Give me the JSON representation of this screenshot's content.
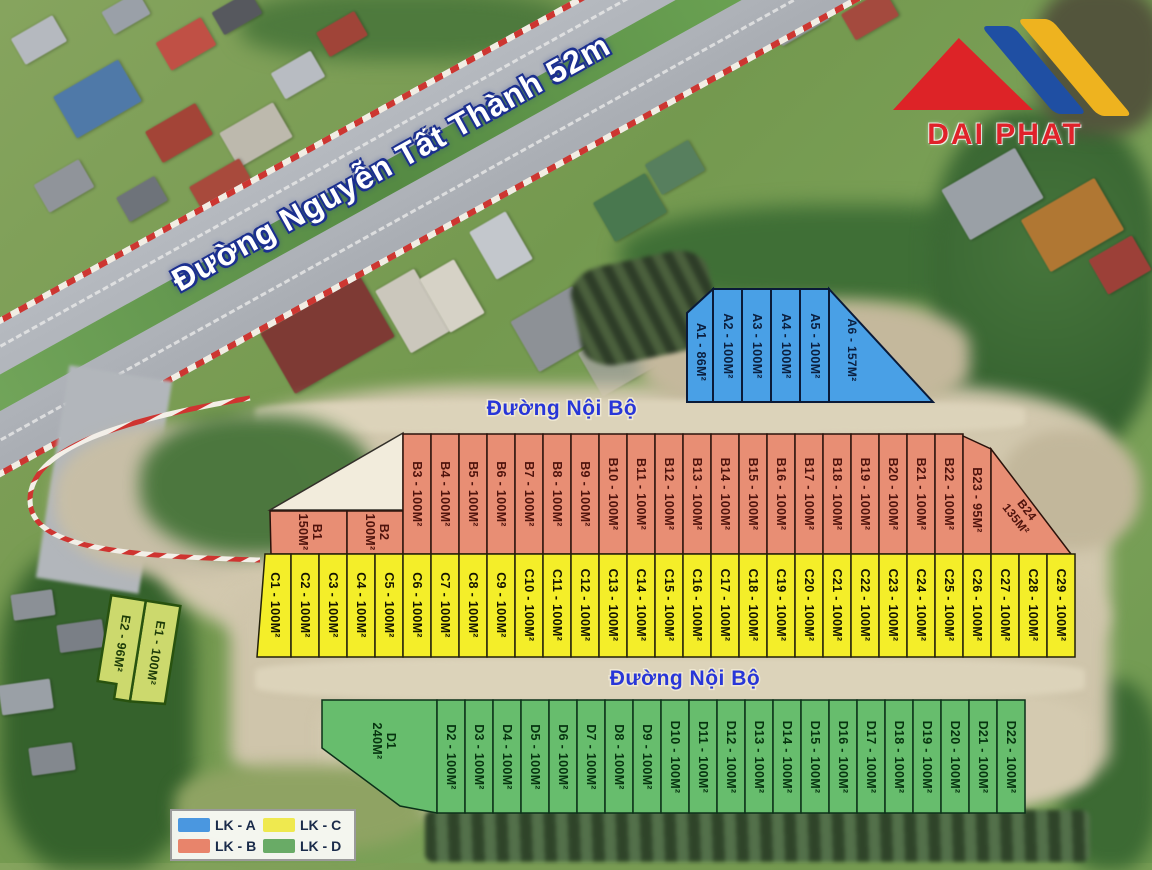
{
  "brand": {
    "logo_text": "DAI PHAT"
  },
  "roads": {
    "main_road_label": "Đường Nguyễn Tất Thành 52m",
    "internal_road_top_label": "Đường Nội Bộ",
    "internal_road_bottom_label": "Đường Nội Bộ"
  },
  "legend": {
    "items": [
      {
        "code": "LK - A",
        "color": "#4a97e0"
      },
      {
        "code": "LK - B",
        "color": "#e8846b"
      },
      {
        "code": "LK - C",
        "color": "#efe94f"
      },
      {
        "code": "LK - D",
        "color": "#69ab66"
      }
    ]
  },
  "blocks": {
    "A": {
      "name": "LK - A",
      "color": "#49a0e6",
      "plots": [
        {
          "id": "A1",
          "area": "86M²"
        },
        {
          "id": "A2",
          "area": "100M²"
        },
        {
          "id": "A3",
          "area": "100M²"
        },
        {
          "id": "A4",
          "area": "100M²"
        },
        {
          "id": "A5",
          "area": "100M²"
        },
        {
          "id": "A6",
          "area": "157M²"
        }
      ]
    },
    "B": {
      "name": "LK - B",
      "color": "#e88e74",
      "plots": [
        {
          "id": "B1",
          "area": "150M²"
        },
        {
          "id": "B2",
          "area": "100M²"
        },
        {
          "id": "B3",
          "area": "100M²"
        },
        {
          "id": "B4",
          "area": "100M²"
        },
        {
          "id": "B5",
          "area": "100M²"
        },
        {
          "id": "B6",
          "area": "100M²"
        },
        {
          "id": "B7",
          "area": "100M²"
        },
        {
          "id": "B8",
          "area": "100M²"
        },
        {
          "id": "B9",
          "area": "100M²"
        },
        {
          "id": "B10",
          "area": "100M²"
        },
        {
          "id": "B11",
          "area": "100M²"
        },
        {
          "id": "B12",
          "area": "100M²"
        },
        {
          "id": "B13",
          "area": "100M²"
        },
        {
          "id": "B14",
          "area": "100M²"
        },
        {
          "id": "B15",
          "area": "100M²"
        },
        {
          "id": "B16",
          "area": "100M²"
        },
        {
          "id": "B17",
          "area": "100M²"
        },
        {
          "id": "B18",
          "area": "100M²"
        },
        {
          "id": "B19",
          "area": "100M²"
        },
        {
          "id": "B20",
          "area": "100M²"
        },
        {
          "id": "B21",
          "area": "100M²"
        },
        {
          "id": "B22",
          "area": "100M²"
        },
        {
          "id": "B23",
          "area": "95M²"
        },
        {
          "id": "B24",
          "area": "135M²"
        }
      ]
    },
    "C": {
      "name": "LK - C",
      "color": "#f4ee29",
      "plots": [
        {
          "id": "C1",
          "area": "100M²"
        },
        {
          "id": "C2",
          "area": "100M²"
        },
        {
          "id": "C3",
          "area": "100M²"
        },
        {
          "id": "C4",
          "area": "100M²"
        },
        {
          "id": "C5",
          "area": "100M²"
        },
        {
          "id": "C6",
          "area": "100M²"
        },
        {
          "id": "C7",
          "area": "100M²"
        },
        {
          "id": "C8",
          "area": "100M²"
        },
        {
          "id": "C9",
          "area": "100M²"
        },
        {
          "id": "C10",
          "area": "100M²"
        },
        {
          "id": "C11",
          "area": "100M²"
        },
        {
          "id": "C12",
          "area": "100M²"
        },
        {
          "id": "C13",
          "area": "100M²"
        },
        {
          "id": "C14",
          "area": "100M²"
        },
        {
          "id": "C15",
          "area": "100M²"
        },
        {
          "id": "C16",
          "area": "100M²"
        },
        {
          "id": "C17",
          "area": "100M²"
        },
        {
          "id": "C18",
          "area": "100M²"
        },
        {
          "id": "C19",
          "area": "100M²"
        },
        {
          "id": "C20",
          "area": "100M²"
        },
        {
          "id": "C21",
          "area": "100M²"
        },
        {
          "id": "C22",
          "area": "100M²"
        },
        {
          "id": "C23",
          "area": "100M²"
        },
        {
          "id": "C24",
          "area": "100M²"
        },
        {
          "id": "C25",
          "area": "100M²"
        },
        {
          "id": "C26",
          "area": "100M²"
        },
        {
          "id": "C27",
          "area": "100M²"
        },
        {
          "id": "C28",
          "area": "100M²"
        },
        {
          "id": "C29",
          "area": "100M²"
        }
      ]
    },
    "D": {
      "name": "LK - D",
      "color": "#67bd6d",
      "plots": [
        {
          "id": "D1",
          "area": "240M²"
        },
        {
          "id": "D2",
          "area": "100M²"
        },
        {
          "id": "D3",
          "area": "100M²"
        },
        {
          "id": "D4",
          "area": "100M²"
        },
        {
          "id": "D5",
          "area": "100M²"
        },
        {
          "id": "D6",
          "area": "100M²"
        },
        {
          "id": "D7",
          "area": "100M²"
        },
        {
          "id": "D8",
          "area": "100M²"
        },
        {
          "id": "D9",
          "area": "100M²"
        },
        {
          "id": "D10",
          "area": "100M²"
        },
        {
          "id": "D11",
          "area": "100M²"
        },
        {
          "id": "D12",
          "area": "100M²"
        },
        {
          "id": "D13",
          "area": "100M²"
        },
        {
          "id": "D14",
          "area": "100M²"
        },
        {
          "id": "D15",
          "area": "100M²"
        },
        {
          "id": "D16",
          "area": "100M²"
        },
        {
          "id": "D17",
          "area": "100M²"
        },
        {
          "id": "D18",
          "area": "100M²"
        },
        {
          "id": "D19",
          "area": "100M²"
        },
        {
          "id": "D20",
          "area": "100M²"
        },
        {
          "id": "D21",
          "area": "100M²"
        },
        {
          "id": "D22",
          "area": "100M²"
        }
      ]
    },
    "E": {
      "name": "E",
      "color": "#ccd96d",
      "plots": [
        {
          "id": "E1",
          "area": "100M²"
        },
        {
          "id": "E2",
          "area": "96M²"
        }
      ]
    }
  }
}
